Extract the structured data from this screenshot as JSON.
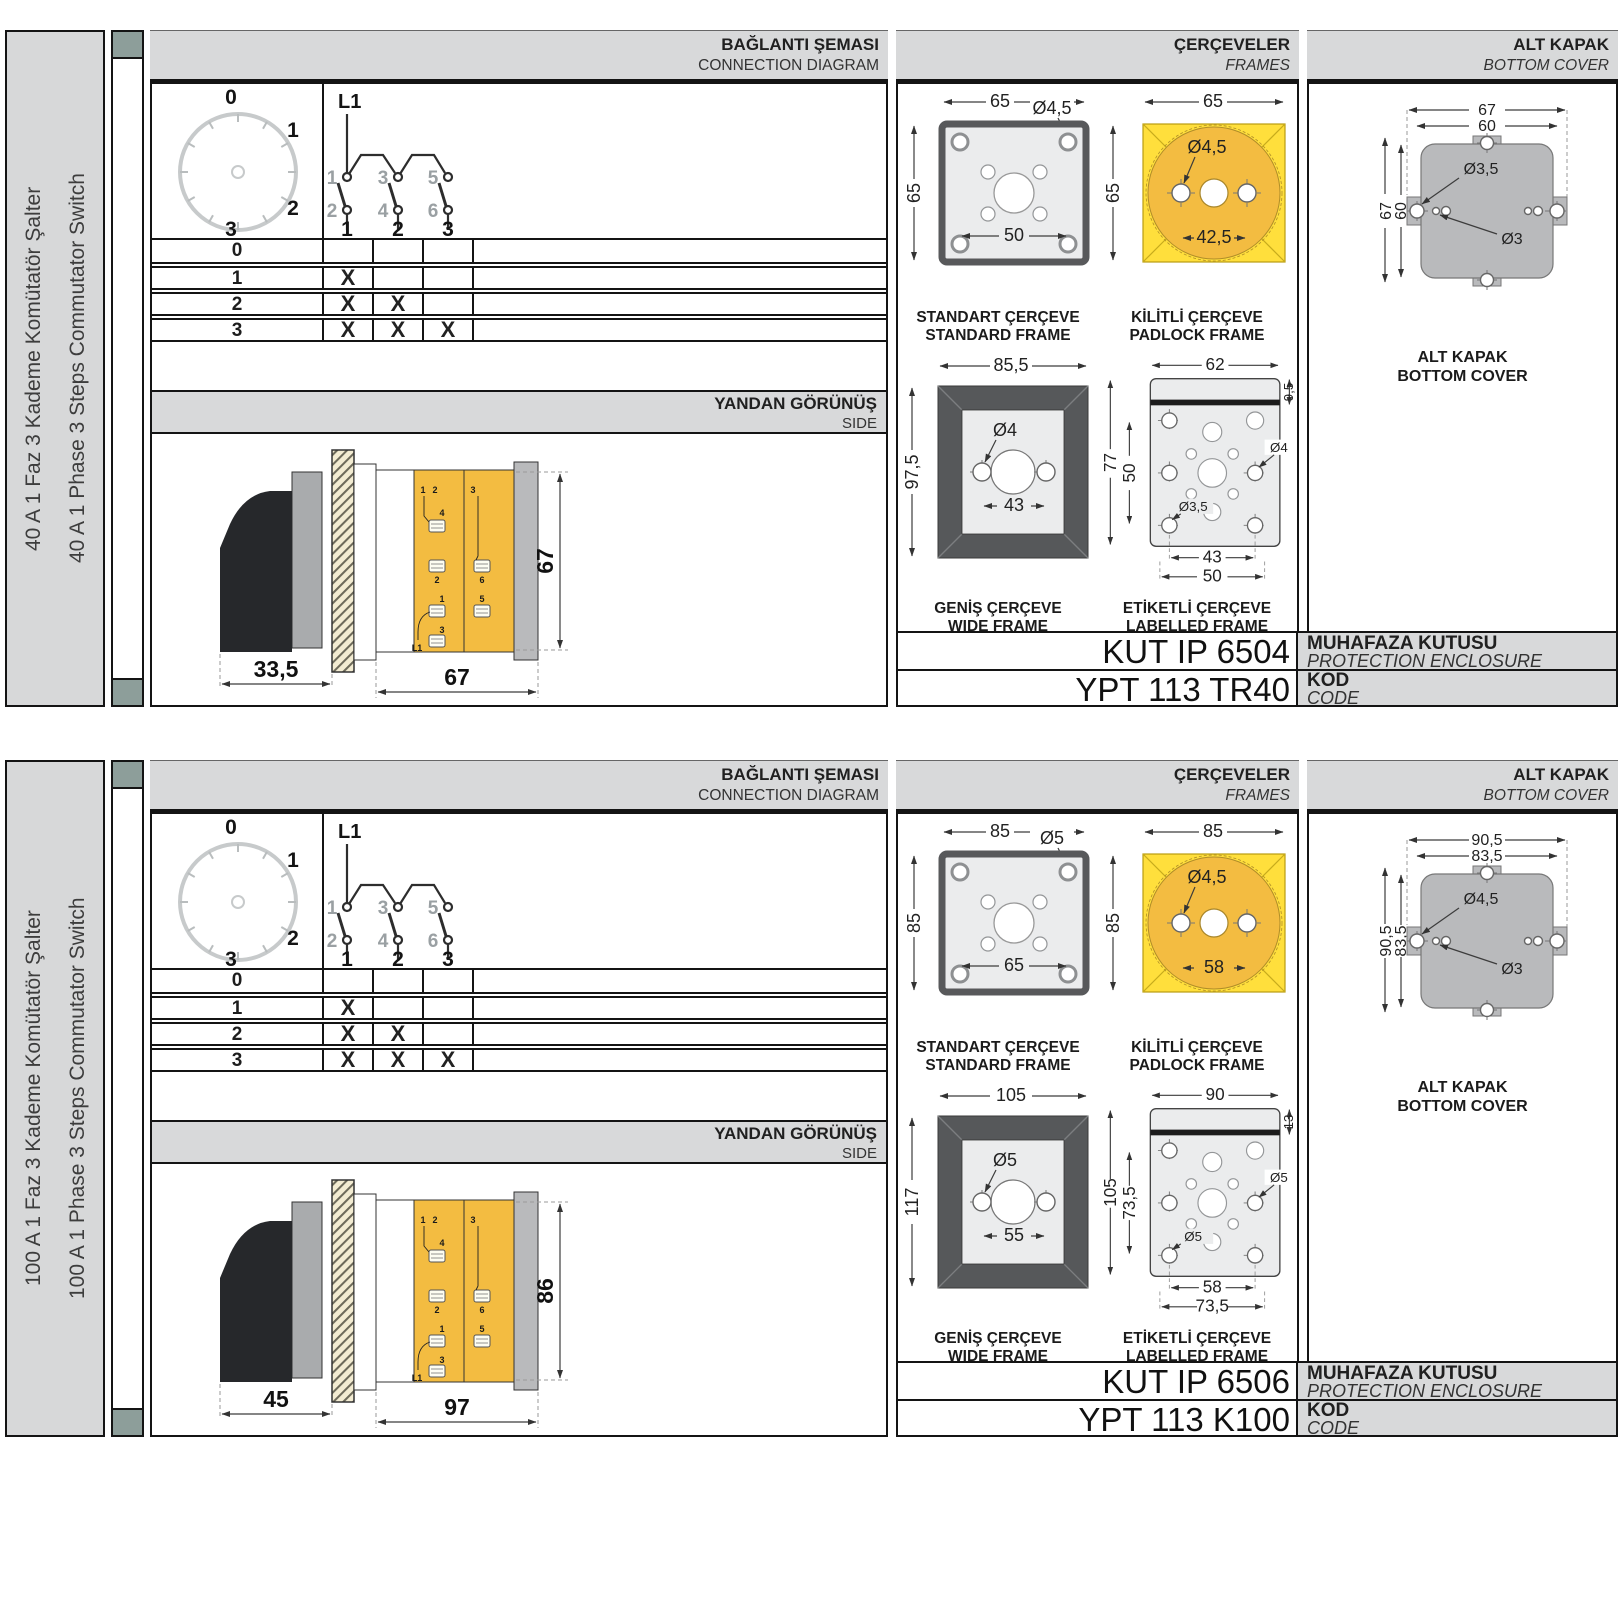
{
  "colors": {
    "yellow": "#ffdf3c",
    "gold": "#f3bc41",
    "panel_gray": "#d8d9da",
    "teal_square": "#8d9e9a",
    "dark_frame": "#56585a"
  },
  "sections": [
    {
      "side_label_tr": "40 A 1 Faz 3 Kademe Komütatör Şalter",
      "side_label_en": "40 A 1 Phase 3 Steps Commutator Switch",
      "headers": {
        "connection_tr": "BAĞLANTI ŞEMASI",
        "connection_en": "CONNECTION DIAGRAM",
        "frames_tr": "ÇERÇEVELER",
        "frames_en": "FRAMES",
        "cover_tr": "ALT KAPAK",
        "cover_en": "BOTTOM COVER"
      },
      "dial": {
        "positions": [
          "0",
          "1",
          "2",
          "3"
        ]
      },
      "circuit": {
        "source": "L1",
        "top_contacts": [
          "1",
          "3",
          "5"
        ],
        "bottom_contacts": [
          "2",
          "4",
          "6"
        ],
        "outputs": [
          "1",
          "2",
          "3"
        ]
      },
      "truth_table": {
        "rows": [
          {
            "label": "0",
            "marks": [
              "",
              "",
              ""
            ]
          },
          {
            "label": "1",
            "marks": [
              "X",
              "",
              ""
            ]
          },
          {
            "label": "2",
            "marks": [
              "X",
              "X",
              ""
            ]
          },
          {
            "label": "3",
            "marks": [
              "X",
              "X",
              "X"
            ]
          }
        ]
      },
      "side_view": {
        "title_tr": "YANDAN GÖRÜNÜŞ",
        "title_en": "SIDE",
        "dim_front": "33,5",
        "dim_body": "67",
        "dim_height": "67",
        "terminals": [
          "1",
          "2",
          "4",
          "2",
          "3",
          "6",
          "1",
          "5",
          "3",
          "L1"
        ]
      },
      "frames": {
        "standard": {
          "tr": "STANDART ÇERÇEVE",
          "en": "STANDARD FRAME",
          "w": "65",
          "h": "65",
          "hole": "Ø4,5",
          "inner": "50"
        },
        "padlock": {
          "tr": "KİLİTLİ ÇERÇEVE",
          "en": "PADLOCK FRAME",
          "w": "65",
          "h": "65",
          "hole": "Ø4,5",
          "inner": "42,5"
        },
        "wide": {
          "tr": "GENİŞ ÇERÇEVE",
          "en": "WIDE FRAME",
          "w": "85,5",
          "h": "97,5",
          "hole": "Ø4",
          "inner": "43"
        },
        "labelled": {
          "tr": "ETİKETLİ ÇERÇEVE",
          "en": "LABELLED FRAME",
          "w": "62",
          "top": "9,5",
          "h": "77",
          "mid": "50",
          "hole_r": "Ø4",
          "hole_b": "Ø3,5",
          "b1": "43",
          "b2": "50"
        }
      },
      "cover": {
        "tr": "ALT KAPAK",
        "en": "BOTTOM COVER",
        "w1": "67",
        "w2": "60",
        "h1": "67",
        "h2": "60",
        "hole1": "Ø3,5",
        "hole2": "Ø3"
      },
      "codes": {
        "enclosure": "KUT IP 6504",
        "enclosure_tr": "MUHAFAZA KUTUSU",
        "enclosure_en": "PROTECTION ENCLOSURE",
        "code": "YPT 113 TR40",
        "code_tr": "KOD",
        "code_en": "CODE"
      }
    },
    {
      "side_label_tr": "100 A 1 Faz 3 Kademe Komütatör Şalter",
      "side_label_en": "100 A 1 Phase 3 Steps Commutator Switch",
      "headers": {
        "connection_tr": "BAĞLANTI ŞEMASI",
        "connection_en": "CONNECTION DIAGRAM",
        "frames_tr": "ÇERÇEVELER",
        "frames_en": "FRAMES",
        "cover_tr": "ALT KAPAK",
        "cover_en": "BOTTOM COVER"
      },
      "dial": {
        "positions": [
          "0",
          "1",
          "2",
          "3"
        ]
      },
      "circuit": {
        "source": "L1",
        "top_contacts": [
          "1",
          "3",
          "5"
        ],
        "bottom_contacts": [
          "2",
          "4",
          "6"
        ],
        "outputs": [
          "1",
          "2",
          "3"
        ]
      },
      "truth_table": {
        "rows": [
          {
            "label": "0",
            "marks": [
              "",
              "",
              ""
            ]
          },
          {
            "label": "1",
            "marks": [
              "X",
              "",
              ""
            ]
          },
          {
            "label": "2",
            "marks": [
              "X",
              "X",
              ""
            ]
          },
          {
            "label": "3",
            "marks": [
              "X",
              "X",
              "X"
            ]
          }
        ]
      },
      "side_view": {
        "title_tr": "YANDAN GÖRÜNÜŞ",
        "title_en": "SIDE",
        "dim_front": "45",
        "dim_body": "97",
        "dim_height": "86",
        "terminals": [
          "1",
          "2",
          "4",
          "2",
          "3",
          "6",
          "1",
          "5",
          "3",
          "L1"
        ]
      },
      "frames": {
        "standard": {
          "tr": "STANDART ÇERÇEVE",
          "en": "STANDARD FRAME",
          "w": "85",
          "h": "85",
          "hole": "Ø5",
          "inner": "65"
        },
        "padlock": {
          "tr": "KİLİTLİ ÇERÇEVE",
          "en": "PADLOCK FRAME",
          "w": "85",
          "h": "85",
          "hole": "Ø4,5",
          "inner": "58"
        },
        "wide": {
          "tr": "GENİŞ ÇERÇEVE",
          "en": "WIDE FRAME",
          "w": "105",
          "h": "117",
          "hole": "Ø5",
          "inner": "55"
        },
        "labelled": {
          "tr": "ETİKETLİ ÇERÇEVE",
          "en": "LABELLED FRAME",
          "w": "90",
          "top": "13",
          "h": "105",
          "mid": "73,5",
          "hole_r": "Ø5",
          "hole_b": "Ø5",
          "b1": "58",
          "b2": "73,5"
        }
      },
      "cover": {
        "tr": "ALT KAPAK",
        "en": "BOTTOM COVER",
        "w1": "90,5",
        "w2": "83,5",
        "h1": "90,5",
        "h2": "83,5",
        "hole1": "Ø4,5",
        "hole2": "Ø3"
      },
      "codes": {
        "enclosure": "KUT IP 6506",
        "enclosure_tr": "MUHAFAZA KUTUSU",
        "enclosure_en": "PROTECTION ENCLOSURE",
        "code": "YPT 113 K100",
        "code_tr": "KOD",
        "code_en": "CODE"
      }
    }
  ]
}
